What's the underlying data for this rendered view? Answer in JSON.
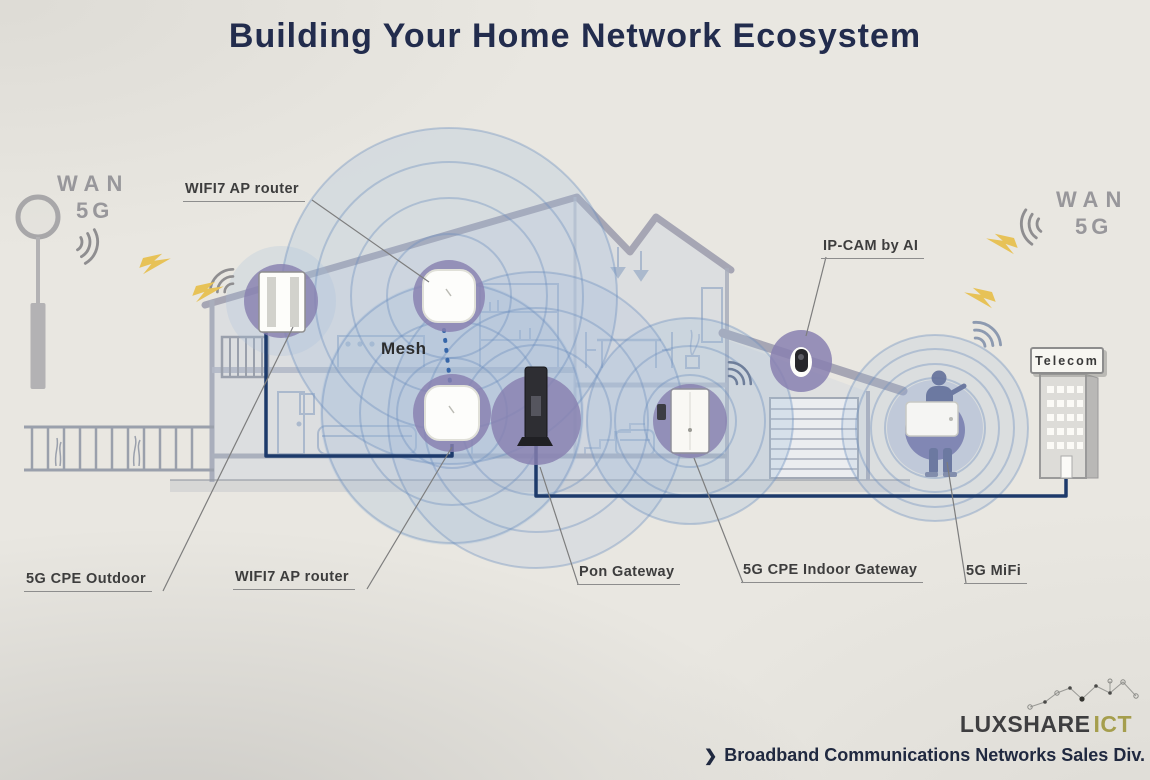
{
  "title": "Building Your Home Network Ecosystem",
  "wan_left": {
    "line1": "WAN",
    "line2": "5G"
  },
  "wan_right": {
    "line1": "WAN",
    "line2": "5G"
  },
  "labels": {
    "wifi7_ap_top": "WIFI7 AP router",
    "mesh": "Mesh",
    "ip_cam": "IP-CAM by AI",
    "cpe_outdoor": "5G CPE Outdoor",
    "wifi7_ap_bottom": "WIFI7 AP router",
    "pon_gateway": "Pon Gateway",
    "cpe_indoor": "5G CPE Indoor Gateway",
    "mifi": "5G MiFi",
    "telecom": "Telecom"
  },
  "footer": {
    "logo_primary": "LUXSHARE",
    "logo_secondary": "ICT",
    "chevron": "❯",
    "division": "Broadband Communications Networks Sales Div."
  },
  "icons": {
    "wifi_signal_icon": "concentric-arcs",
    "lightning_bolt_icon": "zigzag-bolt",
    "mesh_link_icon": "vertical-dotted-line",
    "constellation_icon": "dots-and-lines"
  },
  "colors": {
    "background": "#e9e7e1",
    "title_text": "#222c4d",
    "coverage_blue": "#a3bedb",
    "device_circle_purple": "#8f87b9",
    "cable_navy": "#1d3a6b",
    "lightning_yellow": "#e7c257",
    "wan_gray": "#98979b",
    "label_text": "#3d3d3d",
    "logo_dark": "#3e3e40",
    "logo_olive": "#a59e4d"
  }
}
